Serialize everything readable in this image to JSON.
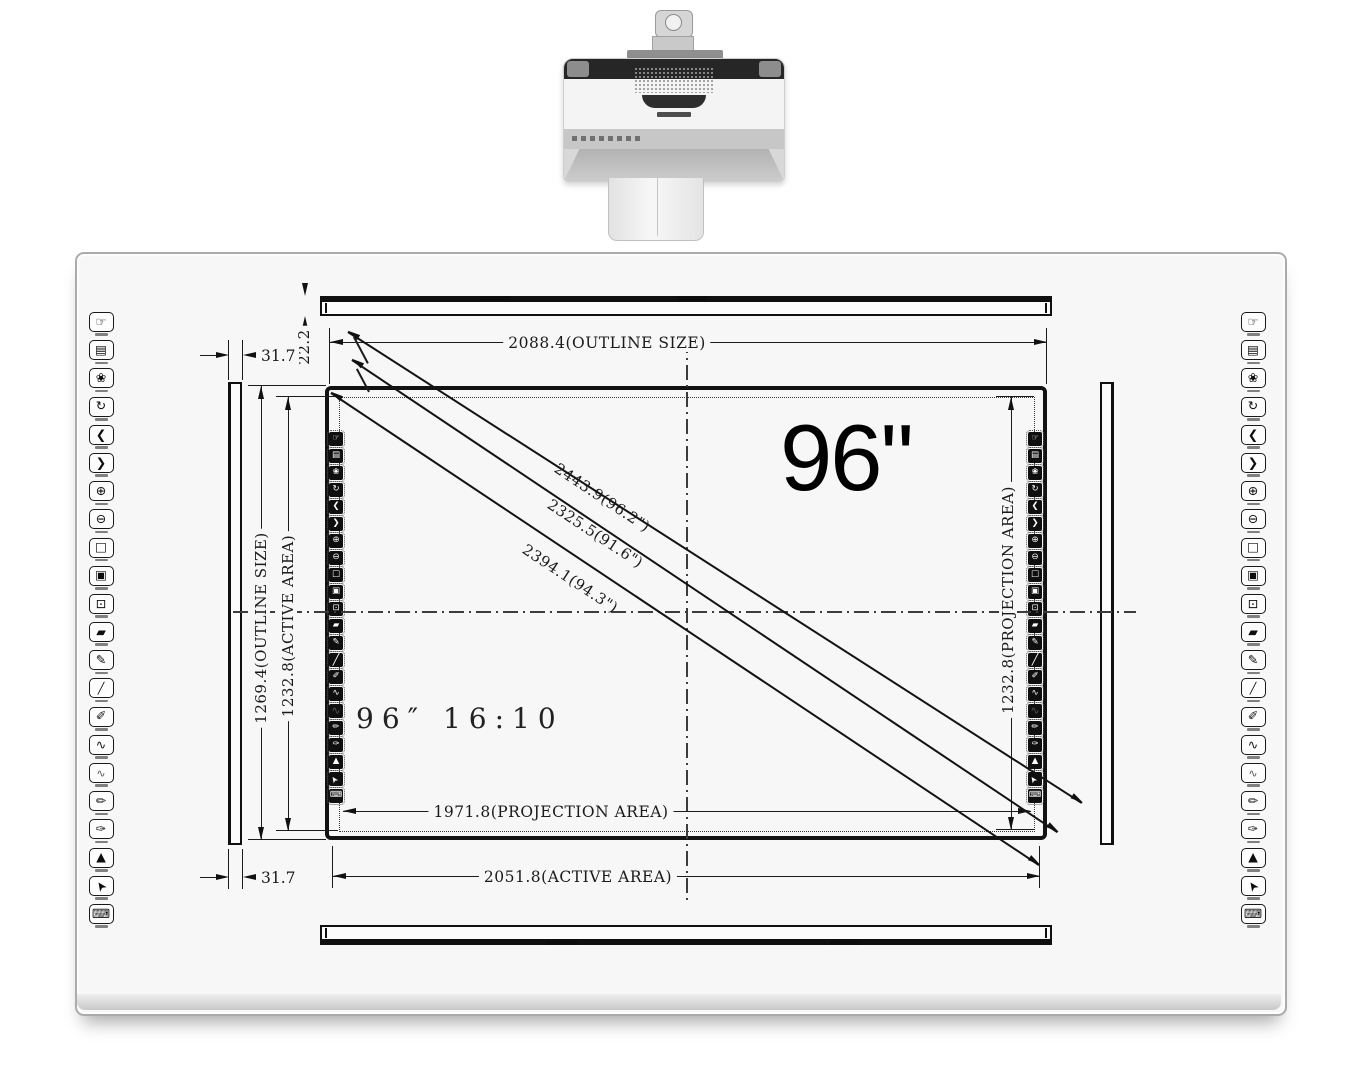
{
  "title": "96 inch interactive whiteboard dimension diagram",
  "colors": {
    "ink": "#1a1a1a",
    "panel": "#f7f7f7",
    "projector_dark": "#262626"
  },
  "callout": {
    "size": "96\"",
    "aspect": "96″ 16:10"
  },
  "dimensions": {
    "outline_width": "2088.4(OUTLINE SIZE)",
    "tray_gap": "22.2",
    "rail_width_top": "31.7",
    "rail_width_bottom": "31.7",
    "outline_height": "1269.4(OUTLINE SIZE)",
    "active_height": "1232.8(ACTIVE AREA)",
    "projection_height": "1232.8(PROJECTION AREA)",
    "projection_width": "1971.8(PROJECTION AREA)",
    "active_width": "2051.8(ACTIVE AREA)",
    "diagonal_outline": "2443.9(96.2\")",
    "diagonal_projection": "2325.5(91.6\")",
    "diagonal_active": "2394.1(94.3\")"
  },
  "toolbar": {
    "icons": [
      {
        "name": "touch-locate-icon",
        "glyph": "☞"
      },
      {
        "name": "print-icon",
        "glyph": "▤"
      },
      {
        "name": "settings-flower-icon",
        "glyph": "❀"
      },
      {
        "name": "refresh-area-icon",
        "glyph": "↻"
      },
      {
        "name": "prev-page-icon",
        "glyph": "❮"
      },
      {
        "name": "next-page-icon",
        "glyph": "❯"
      },
      {
        "name": "zoom-in-icon",
        "glyph": "⊕"
      },
      {
        "name": "zoom-out-icon",
        "glyph": "⊖"
      },
      {
        "name": "screen-frame-1-icon",
        "glyph": "□"
      },
      {
        "name": "screen-frame-2-icon",
        "glyph": "▣"
      },
      {
        "name": "screen-frame-3-icon",
        "glyph": "⊡"
      },
      {
        "name": "eraser-icon",
        "glyph": "▰"
      },
      {
        "name": "marker-pen-icon",
        "glyph": "✎"
      },
      {
        "name": "thin-pen-icon",
        "glyph": "╱"
      },
      {
        "name": "brush-pen-icon",
        "glyph": "✐"
      },
      {
        "name": "curve-bold-icon",
        "glyph": "∿"
      },
      {
        "name": "curve-thin-icon",
        "glyph": "∿"
      },
      {
        "name": "pencil-icon",
        "glyph": "✏"
      },
      {
        "name": "pen-red-icon",
        "glyph": "✑"
      },
      {
        "name": "spotlight-icon",
        "glyph": "▲"
      },
      {
        "name": "cursor-icon",
        "glyph": "➤"
      },
      {
        "name": "keyboard-icon",
        "glyph": "⌨"
      }
    ]
  }
}
